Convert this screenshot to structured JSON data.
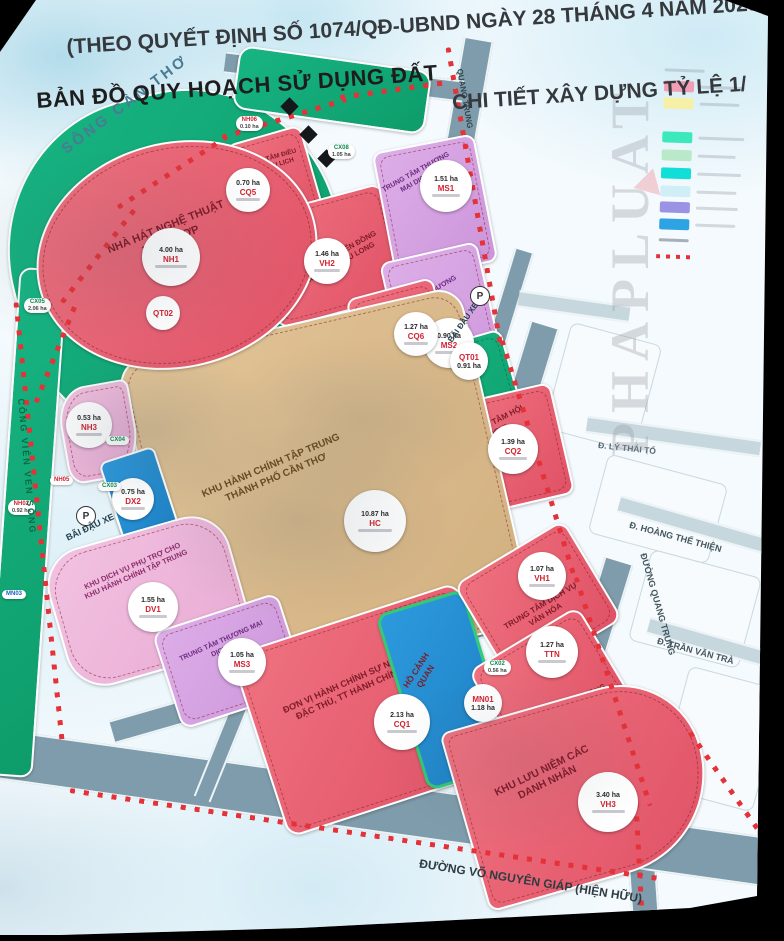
{
  "header": {
    "line1": "(THEO QUYẾT ĐỊNH SỐ 1074/QĐ-UBND NGÀY 28 THÁNG 4 NĂM 2023",
    "line2": "CHI TIẾT XÂY DỰNG TỶ LỆ 1/"
  },
  "title": "BẢN ĐỒ QUY HOẠCH SỬ DỤNG ĐẤT",
  "watermark": "PHAPLUAT",
  "roads": {
    "song_can_tho": "SÔNG CẦN THƠ",
    "cong_vien_ven_song": "CÔNG VIÊN VEN SÔNG",
    "quang_trung": "QUANG TRUNG",
    "duong_quang_trung": "ĐƯỜNG QUANG TRUNG",
    "ly_thai_to": "Đ. LÝ THÁI TỔ",
    "hoang_the_thien": "Đ. HOÀNG THẾ THIỆN",
    "tran_van_tra": "Đ. TRẦN VĂN TRÀ",
    "vo_nguyen_giap": "ĐƯỜNG VÕ NGUYÊN GIÁP (HIỆN HỮU)",
    "bai_dau_xe": "BÃI ĐẬU XE",
    "parking": "P"
  },
  "parcels": [
    {
      "label": "NHÀ HÁT NGHỆ THUẬT TỔNG HỢP",
      "area": "4.00 ha",
      "code": "NH1"
    },
    {
      "label": "TRUNG TÂM ĐIỀU HÀNH DU LỊCH",
      "area": "0.70 ha",
      "code": "CQ5"
    },
    {
      "label": "BẢO TÀNG VĂN HIẾN ĐỒNG BẰNG SÔNG CỬU LONG",
      "area": "1.46 ha",
      "code": "VH2"
    },
    {
      "label": "TRUNG TÂM THƯƠNG MẠI DỊCH VỤ",
      "area": "1.51 ha",
      "code": "MS1"
    },
    {
      "label": "TRUNG TÂM THƯƠNG MẠI DỊCH VỤ",
      "area": "0.90 ha",
      "code": "MS2"
    },
    {
      "label": "TRUNG TÂM TRIỂN LÃM",
      "area": "1.27 ha",
      "code": "CQ6"
    },
    {
      "label": "QUẢNG TRƯỜNG UBND THÀNH PHỐ",
      "area": "0.91 ha",
      "code": "QT01"
    },
    {
      "label": "TRUNG TÂM HỘI NGHỊ",
      "area": "1.39 ha",
      "code": "CQ2"
    },
    {
      "label": "KHU HÀNH CHÍNH TẬP TRUNG THÀNH PHỐ CẦN THƠ",
      "area": "10.87 ha",
      "code": "HC"
    },
    {
      "label": "QUẢNG TRƯỜNG HÀNH CHÍNH VÀ TÂM ĐIỂM",
      "area": "",
      "code": "QT02"
    },
    {
      "label": "",
      "area": "0.53 ha",
      "code": "NH3"
    },
    {
      "label": "",
      "area": "0.75 ha",
      "code": "DX2"
    },
    {
      "label": "KHU DỊCH VỤ PHỤ TRỢ CHO KHU HÀNH CHÍNH TẬP TRUNG",
      "area": "1.55 ha",
      "code": "DV1"
    },
    {
      "label": "TRUNG TÂM THƯƠNG MẠI DỊCH VỤ",
      "area": "1.05 ha",
      "code": "MS3"
    },
    {
      "label": "ĐƠN VỊ HÀNH CHÍNH SỰ NGHIỆP, HỘI ĐẶC THÙ, TT HÀNH CHÍNH CÔNG",
      "area": "2.13 ha",
      "code": "CQ1"
    },
    {
      "label": "HỒ CẢNH QUAN",
      "area": "1.18 ha",
      "code": "MN01"
    },
    {
      "label": "TRUNG TÂM DỊCH VỤ VĂN HÓA",
      "area": "1.07 ha",
      "code": "VH1"
    },
    {
      "label": "TRUNG TÂM HOẠT ĐỘNG THANH THIẾU NHI",
      "area": "1.27 ha",
      "code": "TTN"
    },
    {
      "label": "KHU LƯU NIỆM CÁC DANH NHÂN",
      "area": "3.40 ha",
      "code": "VH3"
    }
  ],
  "tags": [
    {
      "code": "NH06",
      "area": "0.10 ha"
    },
    {
      "code": "CX08",
      "area": "1.05 ha"
    },
    {
      "code": "CX05",
      "area": "2.06 ha"
    },
    {
      "code": "CX04",
      "area": ""
    },
    {
      "code": "NH05",
      "area": ""
    },
    {
      "code": "CX03",
      "area": ""
    },
    {
      "code": "NH02",
      "area": "0.92 ha"
    },
    {
      "code": "MN03",
      "area": ""
    },
    {
      "code": "CX02",
      "area": "0.56 ha"
    }
  ],
  "legend": {
    "swatches": [
      "#f29fb6",
      "#f6f0a6",
      "#3be9bd",
      "#b9e9c9",
      "#12ded8",
      "#cfeef6",
      "#9a93e3",
      "#2da3e3"
    ]
  },
  "colors": {
    "road": "#7e9cab",
    "boundary_dash": "#e53238",
    "parcel_red": "#e05266",
    "parcel_purple": "#cc95da",
    "parcel_green": "#0d9c6a",
    "parcel_tan": "#d2b080",
    "lake_blue": "#1c7fc2"
  }
}
